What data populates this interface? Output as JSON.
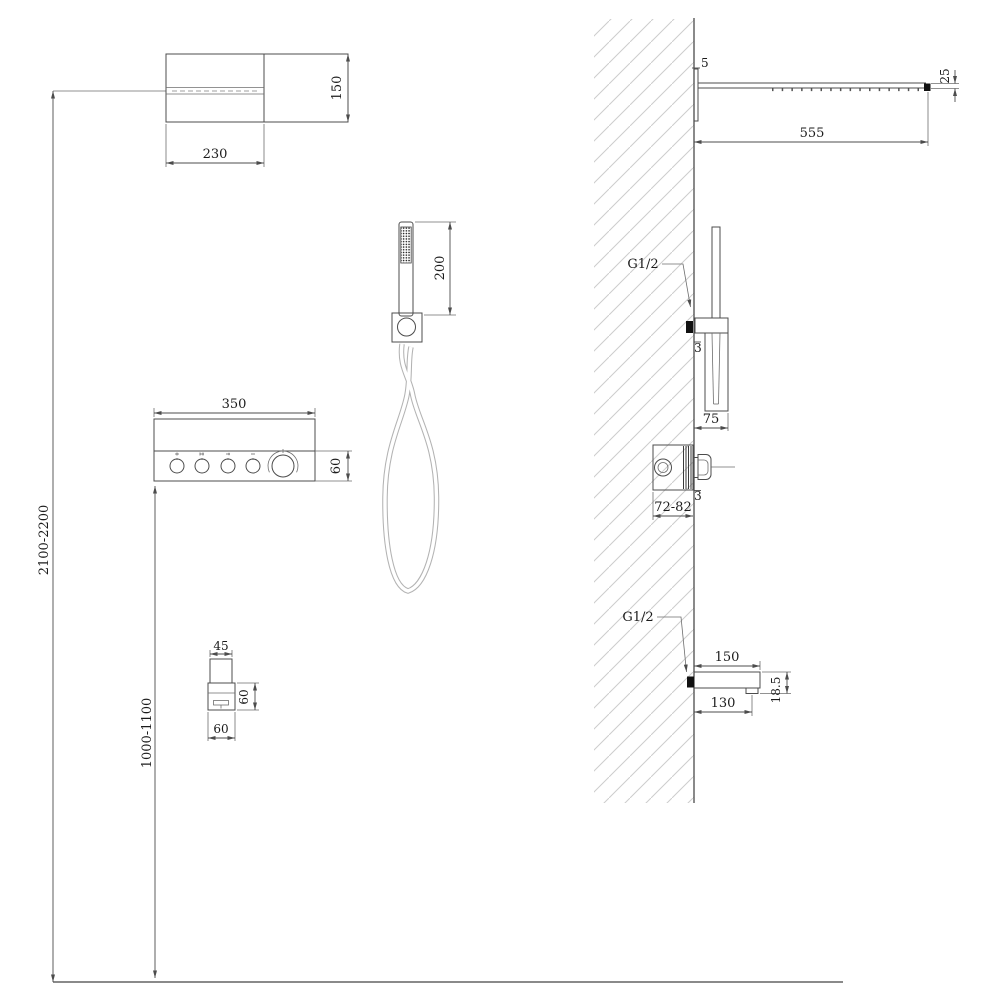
{
  "front_view": {
    "shower_head": {
      "width": "230",
      "height": "150"
    },
    "mixer_panel": {
      "width": "350",
      "strip_height": "60"
    },
    "hand_shower": {
      "length": "200"
    },
    "spout": {
      "tube_width": "45",
      "body_height": "60",
      "body_width": "60"
    },
    "install_heights": {
      "shower_head": "2100-2200",
      "spout": "1000-1100"
    }
  },
  "side_view": {
    "shower_head": {
      "wall_gap": "5",
      "length": "555",
      "end_height": "25"
    },
    "hand_shower": {
      "thread": "G1/2",
      "plate_thickness": "3",
      "holder_depth": "75"
    },
    "mixer_valve": {
      "recess_depth": "72-82",
      "plate_thickness": "3"
    },
    "spout": {
      "thread": "G1/2",
      "reach": "150",
      "outlet_offset": "130",
      "end_height": "18.5"
    }
  },
  "colors": {
    "line": "#4c4c4c",
    "hatch": "#cccccc",
    "connector_fill": "#111111",
    "hose": "#b3b3b3"
  }
}
